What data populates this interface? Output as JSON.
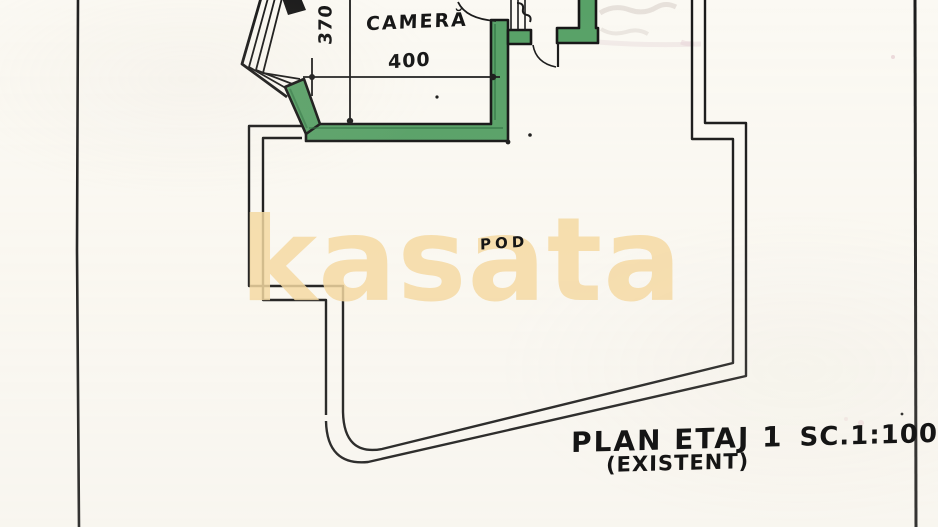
{
  "drawing": {
    "room_label": "CAMERĂ",
    "attic_label": "POD",
    "width_dim": "400",
    "height_dim": "370",
    "title": "PLAN ETAJ 1",
    "scale": "SC.1:100",
    "status": "(EXISTENT)"
  },
  "watermark": {
    "text": "kasata",
    "color": "#f4d9a2"
  },
  "colors": {
    "paper": "#fbf9f3",
    "ink": "#1a1a1a",
    "wall_highlight_fill": "#58a167",
    "wall_highlight_dark": "#2e7040"
  }
}
